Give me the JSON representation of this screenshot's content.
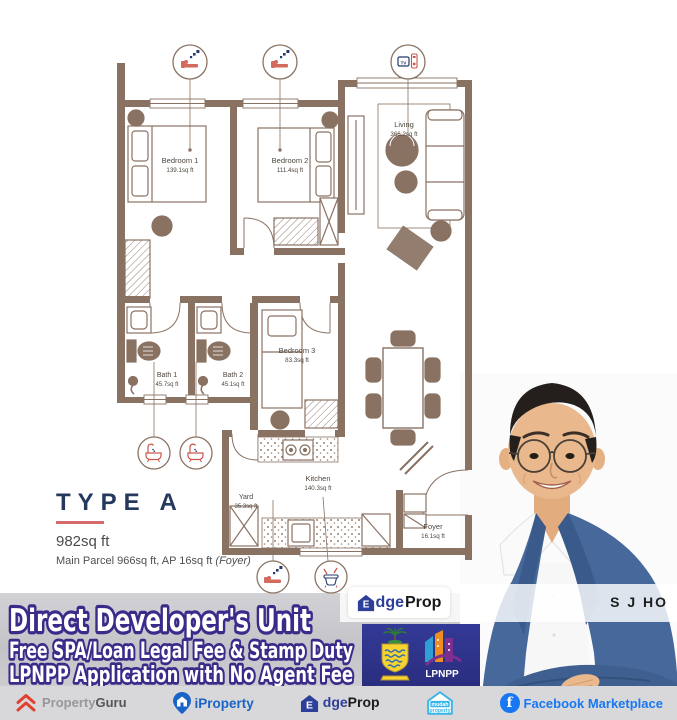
{
  "floor_plan": {
    "type_title": "TYPE A",
    "total_area": "982sq ft",
    "parcel_note": "Main Parcel 966sq ft, AP 16sq ft",
    "parcel_note_suffix": "(Foyer)",
    "rooms": {
      "bedroom1": {
        "name": "Bedroom 1",
        "area": "139.1sq ft"
      },
      "bedroom2": {
        "name": "Bedroom 2",
        "area": "111.4sq ft"
      },
      "living": {
        "name": "Living",
        "area": "366.2sq ft"
      },
      "bedroom3": {
        "name": "Bedroom 3",
        "area": "83.3sq ft"
      },
      "bath1": {
        "name": "Bath 1",
        "area": "45.7sq ft"
      },
      "bath2": {
        "name": "Bath 2",
        "area": "45.1sq ft"
      },
      "kitchen": {
        "name": "Kitchen",
        "area": "140.3sq ft"
      },
      "yard": {
        "name": "Yard",
        "area": "35.3sq ft"
      },
      "foyer": {
        "name": "Foyer",
        "area": "16.1sq ft"
      }
    },
    "icons": {
      "tv": "TV"
    },
    "wall_color": "#8a7263"
  },
  "banner": {
    "line1": "Direct Developer's Unit",
    "line2": "Free SPA/Loan Legal Fee & Stamp Duty",
    "line3": "LPNPP Application with No Agent Fee",
    "text_color": "#ffffff",
    "outline_color": "#3a2b8a"
  },
  "agent": {
    "name": "S J HO"
  },
  "badges": {
    "edgeprop": {
      "e": "E",
      "mid": "dge",
      "end": "Prop"
    },
    "lpnpp": "LPNPP"
  },
  "footer": {
    "propertyguru": {
      "a": "Property",
      "b": "Guru"
    },
    "iproperty": "iProperty",
    "edgeprop": {
      "e": "E",
      "mid": "dge",
      "end": "Prop"
    },
    "mudah": {
      "a": "mudah",
      "b": "property"
    },
    "facebook": {
      "f": "f",
      "label": "Facebook Marketplace"
    }
  }
}
